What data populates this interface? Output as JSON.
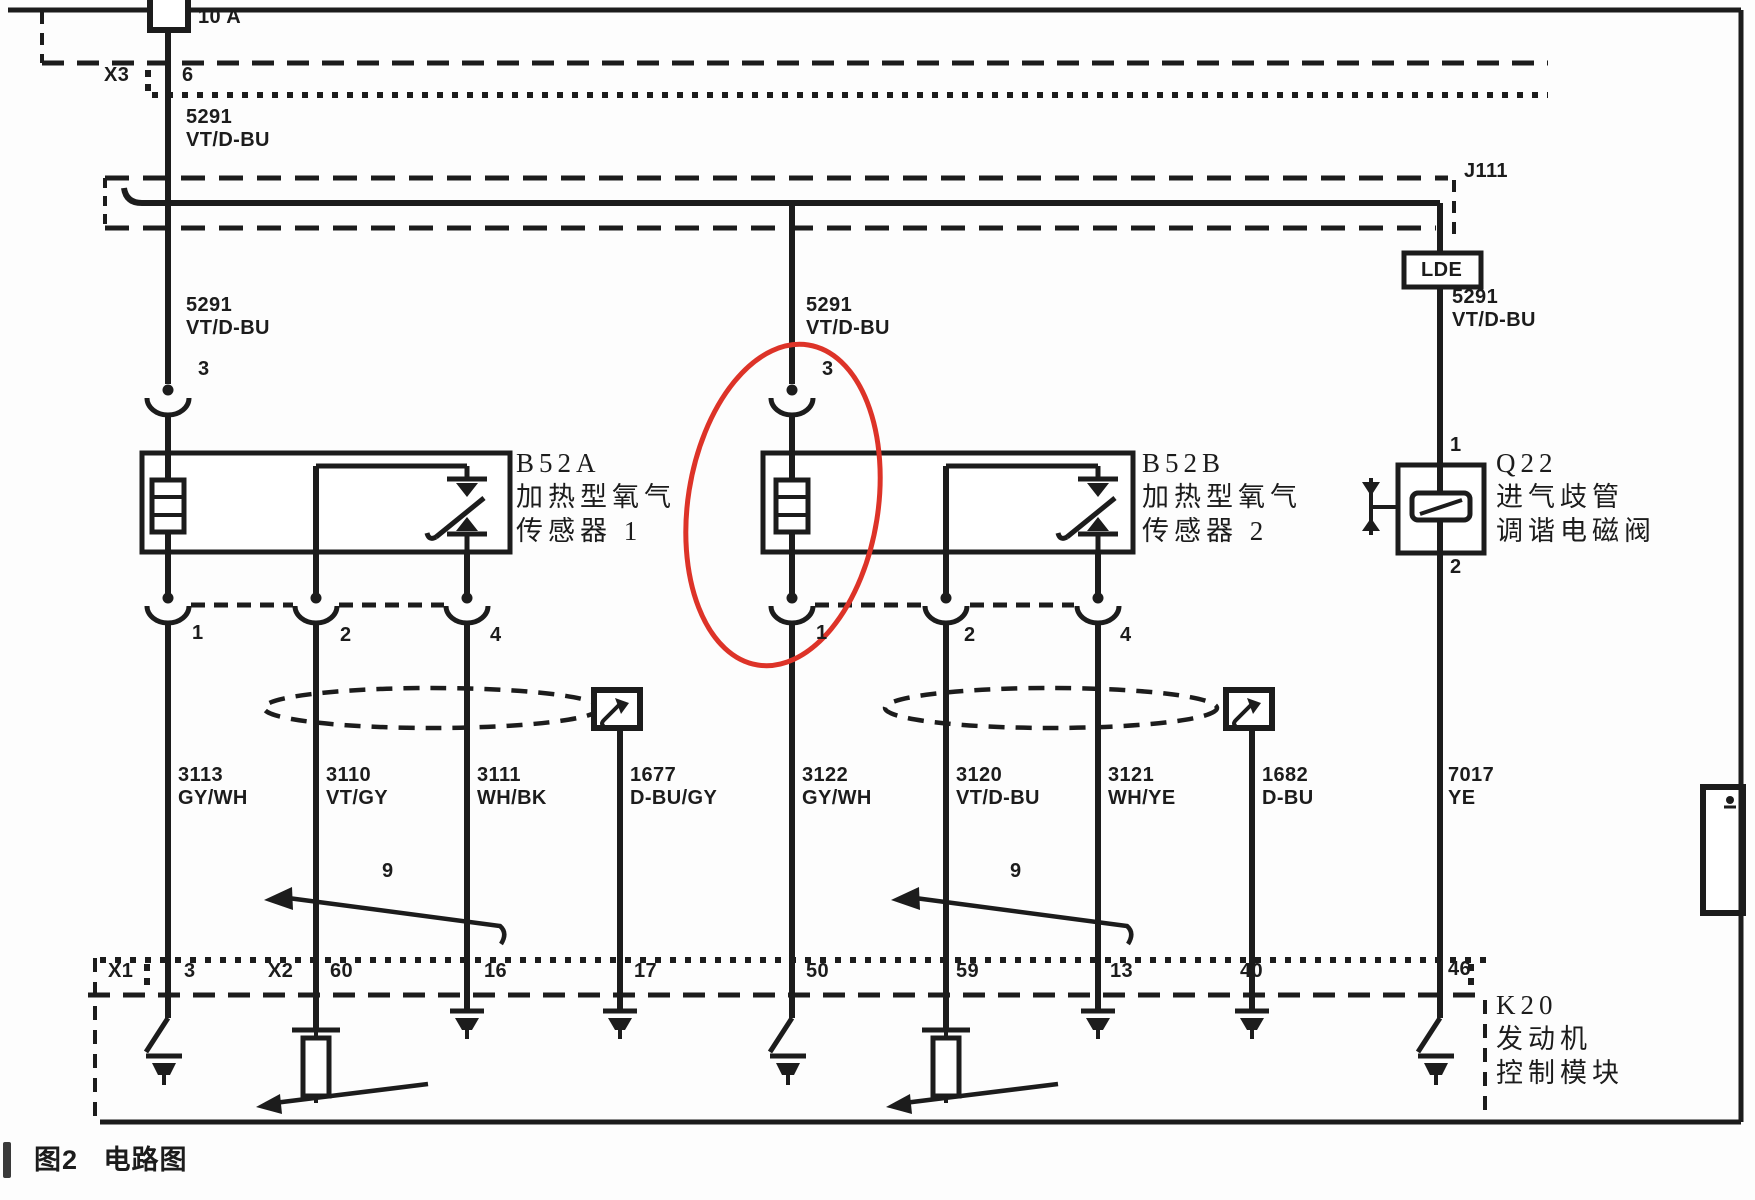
{
  "palette": {
    "line": "#1c1c1c",
    "highlight_red": "#dd3328",
    "paper": "#fdfdfd"
  },
  "caption": {
    "text": "图2   电路图"
  },
  "circuit": {
    "fuse_rating": "10 A",
    "connectors": [
      "X3",
      "J111",
      "LDE",
      "X1",
      "X2"
    ],
    "components": [
      {
        "id": "B52A",
        "name": "加热型氧气传感器 1"
      },
      {
        "id": "B52B",
        "name": "加热型氧气传感器 2"
      },
      {
        "id": "Q22",
        "name": "进气歧管调谐电磁阀"
      },
      {
        "id": "K20",
        "name": "发动机控制模块"
      }
    ],
    "wires": [
      {
        "circuit": "5291",
        "color": "VT/D-BU"
      },
      {
        "circuit": "3113",
        "color": "GY/WH"
      },
      {
        "circuit": "3110",
        "color": "VT/GY"
      },
      {
        "circuit": "3111",
        "color": "WH/BK"
      },
      {
        "circuit": "1677",
        "color": "D-BU/GY"
      },
      {
        "circuit": "3122",
        "color": "GY/WH"
      },
      {
        "circuit": "3120",
        "color": "VT/D-BU"
      },
      {
        "circuit": "3121",
        "color": "WH/YE"
      },
      {
        "circuit": "1682",
        "color": "D-BU"
      },
      {
        "circuit": "7017",
        "color": "YE"
      }
    ],
    "k20_pins": [
      "3",
      "60",
      "16",
      "17",
      "50",
      "59",
      "13",
      "40",
      "46"
    ],
    "sensor_pins": [
      "3",
      "1",
      "2",
      "4"
    ],
    "q22_pins": [
      "1",
      "2"
    ],
    "twist_marker": "9"
  },
  "labels": [
    {
      "name": "fuse-rating-label",
      "text": "10 A",
      "x": 198,
      "y": 6,
      "cls": "wl"
    },
    {
      "name": "connector-x3-label",
      "text": "X3",
      "x": 104,
      "y": 64,
      "cls": "wl"
    },
    {
      "name": "x3-pin-6-label",
      "text": "6",
      "x": 182,
      "y": 64,
      "cls": "wl"
    },
    {
      "name": "wire-5291-label-top",
      "text": "5291\nVT/D-BU",
      "x": 186,
      "y": 106,
      "cls": "wl"
    },
    {
      "name": "junction-j111-label",
      "text": "J111",
      "x": 1464,
      "y": 160,
      "cls": "wl"
    },
    {
      "name": "lde-connector-label",
      "text": "LDE",
      "x": 1421,
      "y": 259,
      "cls": "wl"
    },
    {
      "name": "wire-5291-label-left",
      "text": "5291\nVT/D-BU",
      "x": 186,
      "y": 294,
      "cls": "wl"
    },
    {
      "name": "wire-5291-label-middle",
      "text": "5291\nVT/D-BU",
      "x": 806,
      "y": 294,
      "cls": "wl"
    },
    {
      "name": "wire-5291-label-right",
      "text": "5291\nVT/D-BU",
      "x": 1452,
      "y": 286,
      "cls": "wl"
    },
    {
      "name": "inline-pin-3-label-left",
      "text": "3",
      "x": 198,
      "y": 358,
      "cls": "wl"
    },
    {
      "name": "inline-pin-3-label-middle",
      "text": "3",
      "x": 822,
      "y": 358,
      "cls": "wl"
    },
    {
      "name": "component-b52a-label",
      "text": "B52A\n加热型氧气\n传感器 1",
      "x": 516,
      "y": 446,
      "cls": "comp"
    },
    {
      "name": "component-b52b-label",
      "text": "B52B\n加热型氧气\n传感器 2",
      "x": 1142,
      "y": 446,
      "cls": "comp"
    },
    {
      "name": "component-q22-label",
      "text": "Q22\n进气歧管\n调谐电磁阀",
      "x": 1496,
      "y": 446,
      "cls": "comp"
    },
    {
      "name": "q22-pin-1-label",
      "text": "1",
      "x": 1450,
      "y": 434,
      "cls": "wl"
    },
    {
      "name": "q22-pin-2-label",
      "text": "2",
      "x": 1450,
      "y": 556,
      "cls": "wl"
    },
    {
      "name": "b52a-pin-1-label",
      "text": "1",
      "x": 192,
      "y": 622,
      "cls": "wl"
    },
    {
      "name": "b52a-pin-2-label",
      "text": "2",
      "x": 340,
      "y": 624,
      "cls": "wl"
    },
    {
      "name": "b52a-pin-4-label",
      "text": "4",
      "x": 490,
      "y": 624,
      "cls": "wl"
    },
    {
      "name": "b52b-pin-1-label",
      "text": "1",
      "x": 816,
      "y": 622,
      "cls": "wl"
    },
    {
      "name": "b52b-pin-2-label",
      "text": "2",
      "x": 964,
      "y": 624,
      "cls": "wl"
    },
    {
      "name": "b52b-pin-4-label",
      "text": "4",
      "x": 1120,
      "y": 624,
      "cls": "wl"
    },
    {
      "name": "wire-3113-label",
      "text": "3113\nGY/WH",
      "x": 178,
      "y": 764,
      "cls": "wl"
    },
    {
      "name": "wire-3110-label",
      "text": "3110\nVT/GY",
      "x": 326,
      "y": 764,
      "cls": "wl"
    },
    {
      "name": "wire-3111-label",
      "text": "3111\nWH/BK",
      "x": 477,
      "y": 764,
      "cls": "wl"
    },
    {
      "name": "wire-1677-label",
      "text": "1677\nD-BU/GY",
      "x": 630,
      "y": 764,
      "cls": "wl"
    },
    {
      "name": "wire-3122-label",
      "text": "3122\nGY/WH",
      "x": 802,
      "y": 764,
      "cls": "wl"
    },
    {
      "name": "wire-3120-label",
      "text": "3120\nVT/D-BU",
      "x": 956,
      "y": 764,
      "cls": "wl"
    },
    {
      "name": "wire-3121-label",
      "text": "3121\nWH/YE",
      "x": 1108,
      "y": 764,
      "cls": "wl"
    },
    {
      "name": "wire-1682-label",
      "text": "1682\nD-BU",
      "x": 1262,
      "y": 764,
      "cls": "wl"
    },
    {
      "name": "wire-7017-label",
      "text": "7017\nYE",
      "x": 1448,
      "y": 764,
      "cls": "wl"
    },
    {
      "name": "twist-label-left",
      "text": "9",
      "x": 382,
      "y": 860,
      "cls": "wl"
    },
    {
      "name": "twist-label-right",
      "text": "9",
      "x": 1010,
      "y": 860,
      "cls": "wl"
    },
    {
      "name": "connector-x1-label",
      "text": "X1",
      "x": 108,
      "y": 960,
      "cls": "wl"
    },
    {
      "name": "k20-pin-3-label",
      "text": "3",
      "x": 184,
      "y": 960,
      "cls": "wl"
    },
    {
      "name": "connector-x2-label",
      "text": "X2",
      "x": 268,
      "y": 960,
      "cls": "wl"
    },
    {
      "name": "k20-pin-60-label",
      "text": "60",
      "x": 330,
      "y": 960,
      "cls": "wl"
    },
    {
      "name": "k20-pin-16-label",
      "text": "16",
      "x": 484,
      "y": 960,
      "cls": "wl"
    },
    {
      "name": "k20-pin-17-label",
      "text": "17",
      "x": 634,
      "y": 960,
      "cls": "wl"
    },
    {
      "name": "k20-pin-50-label",
      "text": "50",
      "x": 806,
      "y": 960,
      "cls": "wl"
    },
    {
      "name": "k20-pin-59-label",
      "text": "59",
      "x": 956,
      "y": 960,
      "cls": "wl"
    },
    {
      "name": "k20-pin-13-label",
      "text": "13",
      "x": 1110,
      "y": 960,
      "cls": "wl"
    },
    {
      "name": "k20-pin-40-label",
      "text": "40",
      "x": 1240,
      "y": 960,
      "cls": "wl"
    },
    {
      "name": "k20-pin-46-label",
      "text": "46",
      "x": 1448,
      "y": 958,
      "cls": "wl"
    },
    {
      "name": "component-k20-label",
      "text": "K20\n发动机\n控制模块",
      "x": 1496,
      "y": 988,
      "cls": "comp"
    }
  ]
}
